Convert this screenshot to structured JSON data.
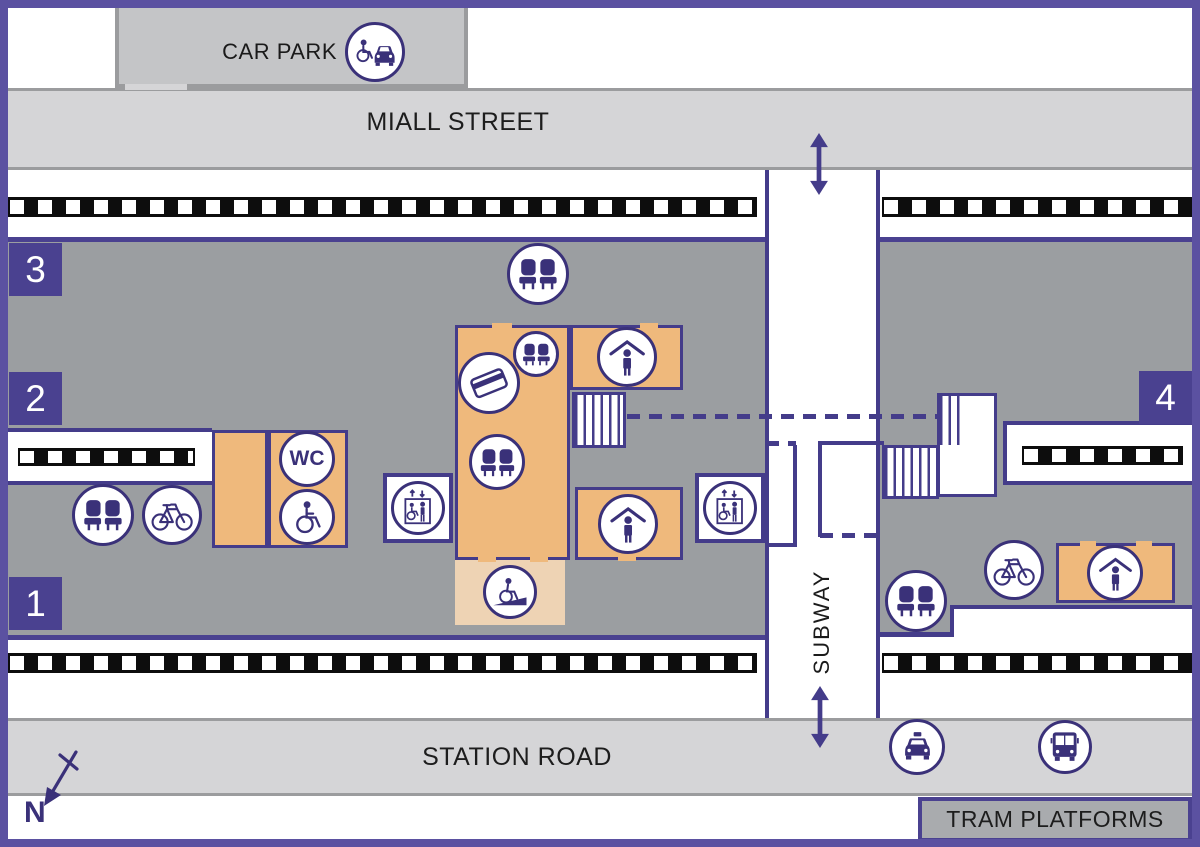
{
  "labels": {
    "car_park": "CAR PARK",
    "miall_street": "MIALL STREET",
    "station_road": "STATION ROAD",
    "subway": "SUBWAY",
    "tram_platforms": "TRAM PLATFORMS",
    "compass_north": "N"
  },
  "platform_badges": [
    {
      "number": "3",
      "x": 9,
      "y": 243
    },
    {
      "number": "2",
      "x": 9,
      "y": 372
    },
    {
      "number": "1",
      "x": 9,
      "y": 577
    },
    {
      "number": "4",
      "x": 1139,
      "y": 371
    }
  ],
  "facility_markers": [
    {
      "icon": "accessible-parking",
      "x": 375,
      "y": 52,
      "r": 30
    },
    {
      "icon": "seats",
      "x": 538,
      "y": 274,
      "r": 31
    },
    {
      "icon": "seats",
      "x": 536,
      "y": 354,
      "r": 23
    },
    {
      "icon": "ticket-machine",
      "x": 489,
      "y": 383,
      "r": 31
    },
    {
      "icon": "seats",
      "x": 497,
      "y": 462,
      "r": 28
    },
    {
      "icon": "waiting-shelter",
      "x": 627,
      "y": 357,
      "r": 30
    },
    {
      "icon": "waiting-shelter",
      "x": 628,
      "y": 524,
      "r": 30
    },
    {
      "icon": "wheelchair-ramp",
      "x": 510,
      "y": 592,
      "r": 27
    },
    {
      "icon": "wc",
      "x": 307,
      "y": 459,
      "r": 28,
      "text": "WC"
    },
    {
      "icon": "accessible-toilet",
      "x": 307,
      "y": 517,
      "r": 28
    },
    {
      "icon": "seats",
      "x": 103,
      "y": 515,
      "r": 31
    },
    {
      "icon": "bicycle",
      "x": 172,
      "y": 515,
      "r": 30
    },
    {
      "icon": "lift",
      "x": 418,
      "y": 508,
      "r": 27,
      "box": true
    },
    {
      "icon": "lift",
      "x": 730,
      "y": 508,
      "r": 27,
      "box": true
    },
    {
      "icon": "seats",
      "x": 916,
      "y": 601,
      "r": 31
    },
    {
      "icon": "bicycle",
      "x": 1014,
      "y": 570,
      "r": 30
    },
    {
      "icon": "waiting-shelter",
      "x": 1115,
      "y": 573,
      "r": 28
    },
    {
      "icon": "taxi",
      "x": 917,
      "y": 747,
      "r": 28
    },
    {
      "icon": "bus",
      "x": 1065,
      "y": 747,
      "r": 27
    }
  ],
  "colors": {
    "icon_purple": "#3a3179",
    "line_purple": "#443c8a",
    "frame_purple": "#5b51a1",
    "badge_purple": "#4a4190",
    "building_orange": "#efb97c",
    "ramp_tan": "#eed3b4",
    "platform_grey": "#9b9ea1",
    "street_grey": "#d5d5d7",
    "carpark_grey": "#c4c5c7",
    "tram_grey": "#a9abae",
    "track_black": "#0d0d0d"
  }
}
